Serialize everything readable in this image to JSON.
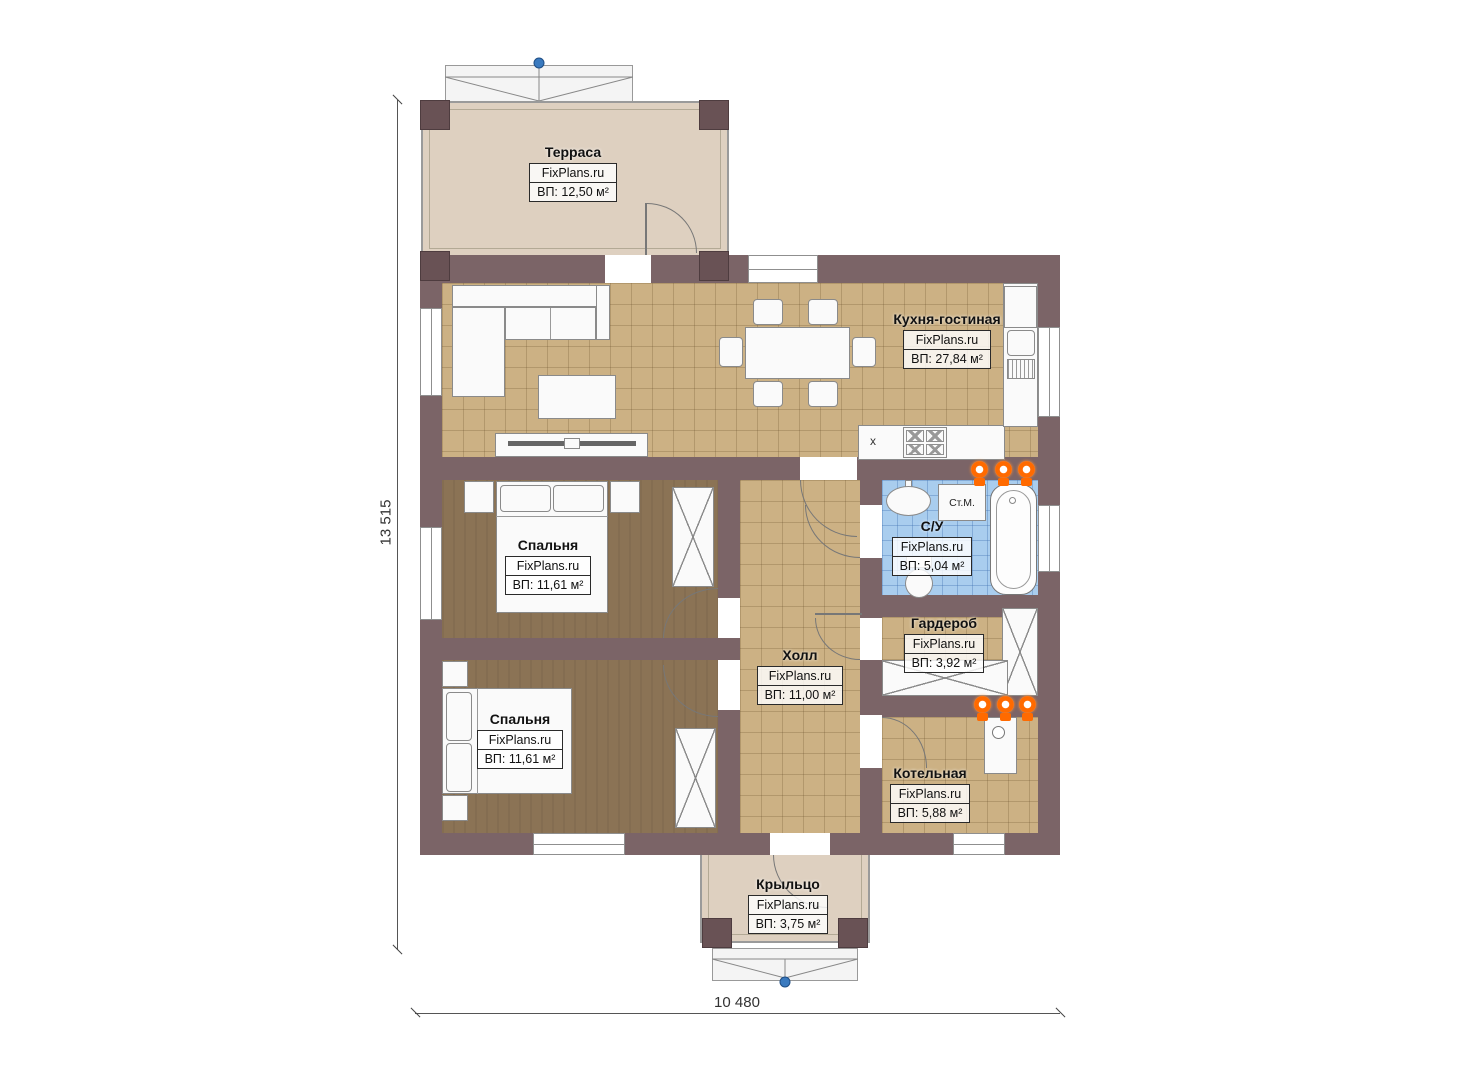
{
  "brand": "FixPlans.ru",
  "dimensions": {
    "width": "10 480",
    "height": "13 515"
  },
  "rooms": [
    {
      "id": "terrace",
      "name": "Терраса",
      "area": "ВП: 12,50 м²"
    },
    {
      "id": "kitchen_living",
      "name": "Кухня-гостиная",
      "area": "ВП: 27,84 м²"
    },
    {
      "id": "bedroom_top",
      "name": "Спальня",
      "area": "ВП: 11,61 м²"
    },
    {
      "id": "bedroom_bottom",
      "name": "Спальня",
      "area": "ВП: 11,61 м²"
    },
    {
      "id": "hall",
      "name": "Холл",
      "area": "ВП: 11,00 м²"
    },
    {
      "id": "bathroom",
      "name": "С/У",
      "area": "ВП: 5,04 м²"
    },
    {
      "id": "wardrobe",
      "name": "Гардероб",
      "area": "ВП: 3,92 м²"
    },
    {
      "id": "boiler",
      "name": "Котельная",
      "area": "ВП: 5,88 м²"
    },
    {
      "id": "porch",
      "name": "Крыльцо",
      "area": "ВП: 3,75 м²"
    }
  ],
  "annotations": {
    "washing_machine": "Ст.М.",
    "sink_mark": "x"
  },
  "colors": {
    "wall": "#7b6467",
    "floor_tile": "#ccb184",
    "bedroom_floor": "#8b7355",
    "bathroom_tile": "#a9cdee",
    "terrace_floor": "#ded0c0",
    "heating_orange": "#ff6a00",
    "marker_blue": "#3a7abf"
  }
}
